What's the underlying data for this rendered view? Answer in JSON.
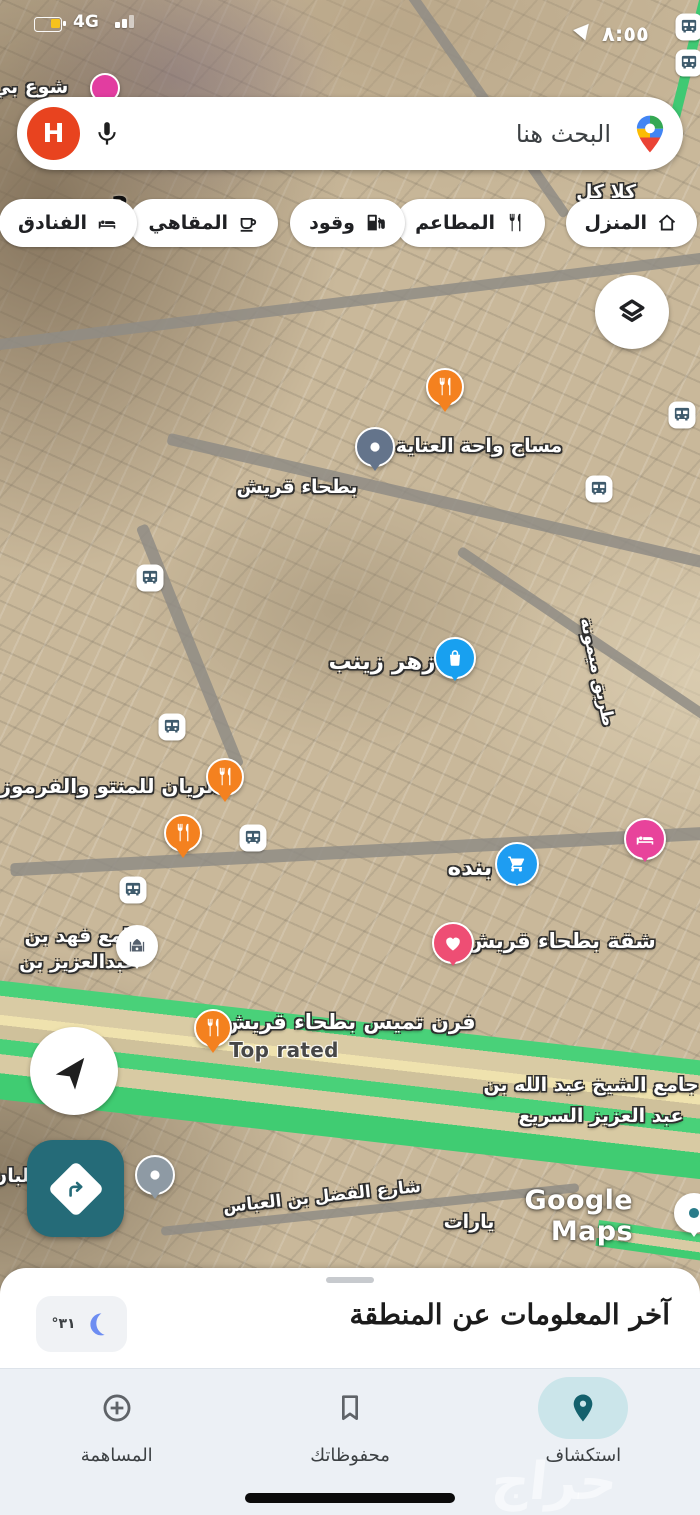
{
  "status_bar": {
    "network": "4G",
    "time": "٨:٥٥",
    "battery_color": "#f6c21c"
  },
  "search_bar": {
    "placeholder": "البحث هنا",
    "avatar_letter": "H"
  },
  "chips": {
    "items": [
      {
        "label": "المنزل",
        "icon": "home-icon"
      },
      {
        "label": "المطاعم",
        "icon": "restaurant-icon"
      },
      {
        "label": "وقود",
        "icon": "fuel-icon"
      },
      {
        "label": "المقاهي",
        "icon": "cafe-icon"
      },
      {
        "label": "الفنادق",
        "icon": "hotel-icon"
      }
    ]
  },
  "map": {
    "watermark": "Google Maps",
    "labels": [
      {
        "text": "شوع بي"
      },
      {
        "text": "كلا كل"
      },
      {
        "text": "3"
      },
      {
        "text": "مساج واحة العناية"
      },
      {
        "text": "بطحاء قريش"
      },
      {
        "text": "زهر زينب"
      },
      {
        "text": "طريق ميمونة"
      },
      {
        "text": "الريان للمنتو والفرموزة"
      },
      {
        "text": "بنده"
      },
      {
        "text": "شقة بطحاء قريش"
      },
      {
        "text": "جامع فهد بن"
      },
      {
        "text": "عبدالعزيز بن"
      },
      {
        "text": "فرن تميس بطحاء قريش"
      },
      {
        "text": "Top rated"
      },
      {
        "text": "جامع الشيخ عبد الله بن"
      },
      {
        "text": "عبد العزيز السريع"
      },
      {
        "text": "شارع الفضل بن العباس"
      },
      {
        "text": "للبان"
      },
      {
        "text": "يارات"
      }
    ],
    "markers": [
      {
        "name": "restaurant-pin",
        "color": "#f4811f",
        "count": 4
      },
      {
        "name": "shopping-bag-pin",
        "color": "#18a0f0",
        "count": 1
      },
      {
        "name": "shopping-cart-pin",
        "color": "#1e9df2",
        "count": 1
      },
      {
        "name": "hotel-pin",
        "color": "#e8439b",
        "count": 1
      },
      {
        "name": "favorite-heart-pin",
        "color": "#ee4e74",
        "count": 1
      },
      {
        "name": "mosque-pin",
        "color": "#ffffff",
        "count": 1
      },
      {
        "name": "spa-pin",
        "color": "#64748b",
        "count": 1
      },
      {
        "name": "generic-pin",
        "color": "#8e9aa4",
        "count": 2
      },
      {
        "name": "bus-stop",
        "color": "#3f5b6d",
        "count": 8
      }
    ],
    "highway_green": "#49d179"
  },
  "sheet": {
    "title": "آخر المعلومات عن المنطقة",
    "temperature": "٣١°"
  },
  "bottom_nav": {
    "items": [
      {
        "label": "استكشاف",
        "active": true
      },
      {
        "label": "محفوظاتك",
        "active": false
      },
      {
        "label": "المساهمة",
        "active": false
      }
    ]
  },
  "overlay_watermark": "حراج",
  "colors": {
    "accent_teal": "#256b78",
    "active_pill": "#cbe5ea",
    "sheet_bg": "#ffffff",
    "nav_bg": "#ecf0f5"
  }
}
